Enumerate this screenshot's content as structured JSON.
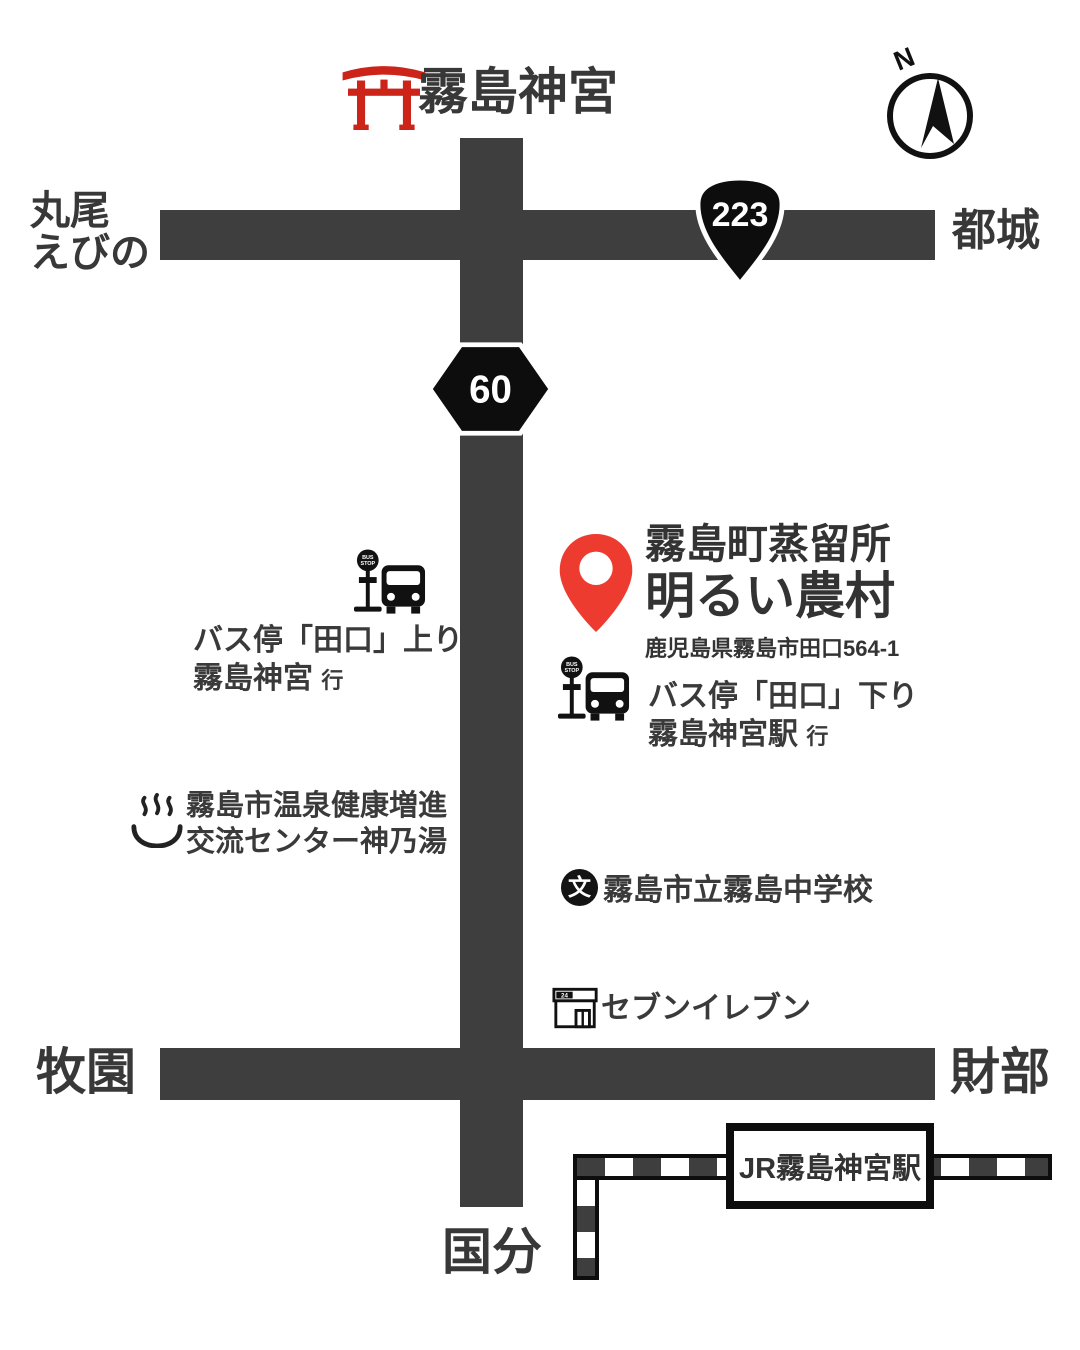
{
  "header": {
    "title": "霧島神宮",
    "compass_north": "N"
  },
  "roads": {
    "route223": "223",
    "route60": "60",
    "west_line1": "丸尾",
    "west_line2": "えびの",
    "east": "都城",
    "southwest": "牧園",
    "southeast": "財部",
    "south": "国分"
  },
  "destination": {
    "name_line1": "霧島町蒸留所",
    "name_line2": "明るい農村",
    "address": "鹿児島県霧島市田口564-1"
  },
  "bus_stops": [
    {
      "sign_line1": "BUS",
      "sign_line2": "STOP",
      "name": "バス停「田口」上り",
      "direction": "霧島神宮",
      "direction_suffix": "行"
    },
    {
      "sign_line1": "BUS",
      "sign_line2": "STOP",
      "name": "バス停「田口」下り",
      "direction": "霧島神宮駅",
      "direction_suffix": "行"
    }
  ],
  "pois": {
    "onsen": {
      "name_line1": "霧島市温泉健康増進",
      "name_line2": "交流センター神乃湯"
    },
    "school": {
      "icon_glyph": "文",
      "name": "霧島市立霧島中学校"
    },
    "store": {
      "icon_sign": "24",
      "name": "セブンイレブン"
    }
  },
  "station": {
    "name": "JR霧島神宮駅"
  },
  "colors": {
    "road": "#3e3e3e",
    "marker_red": "#ee3b30",
    "torii_red": "#cc2418",
    "ink": "#111111",
    "text": "#333333"
  }
}
